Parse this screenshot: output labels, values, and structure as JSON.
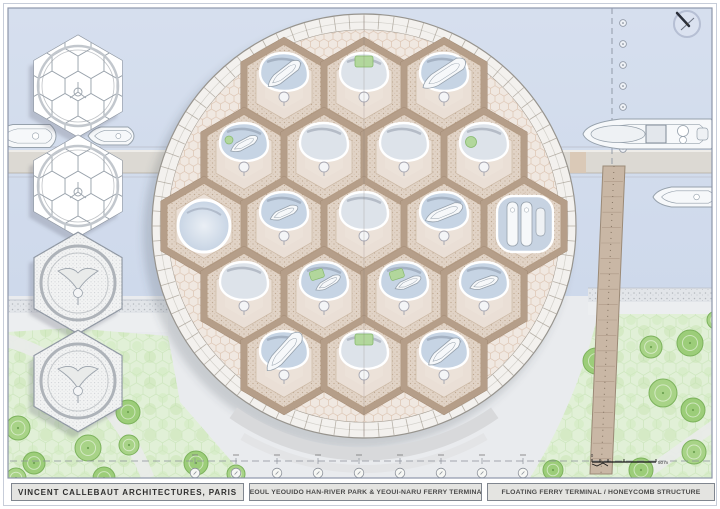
{
  "titleblock": {
    "firm": "VINCENT CALLEBAUT ARCHITECTURES, PARIS",
    "project": "SEOUL YEOUIDO HAN-RIVER PARK & YEOUI-NARU FERRY TERMINAL",
    "drawing": "FLOATING FERRY TERMINAL / HONEYCOMB STRUCTURE"
  },
  "scalebar": {
    "start_label": "0",
    "end_label": "50 m"
  },
  "compass": {
    "type": "north-needle"
  },
  "colors": {
    "water_top": "#d6dfee",
    "water_bottom": "#c9d5e9",
    "land": "#e9ebee",
    "promenade": "#eceef0",
    "sand_base": "#e2e5e9",
    "park": "#e1f0d7",
    "tree": "#a8d387",
    "tree_line": "#7cb25c",
    "band": "#dcd9d1",
    "pier": "#c9b7a5",
    "ring": "#f3f1ee",
    "ring_line": "#a39c92",
    "filler": "#f0e8e1",
    "filler_line": "#ddc5b3",
    "web": "#b59e89",
    "cell": "#e1d3c6",
    "cell_inner": "#eadfd6",
    "cell_core": "#ece2d9",
    "open_blue": "#c6d4e4",
    "open_gray": "#dde3ea",
    "green": "#b2d79c",
    "green_line": "#86b96d",
    "boat": "#f6f8fa",
    "boat_line": "#96a1ac",
    "shadow": "rgba(70,75,90,0.20)",
    "frame": "#8e97ab"
  },
  "plan": {
    "center": [
      364,
      226
    ],
    "outer_radius": 212,
    "ring_radius": 196,
    "hex_width": 80,
    "cells": [
      {
        "x": 284,
        "y": 87,
        "type": "boat",
        "angle": -38
      },
      {
        "x": 364,
        "y": 87,
        "type": "green"
      },
      {
        "x": 444,
        "y": 87,
        "type": "boat-large",
        "angle": -33
      },
      {
        "x": 244,
        "y": 157,
        "type": "boat-green",
        "angle": -28
      },
      {
        "x": 324,
        "y": 157,
        "type": "plain"
      },
      {
        "x": 404,
        "y": 157,
        "type": "plain"
      },
      {
        "x": 484,
        "y": 157,
        "type": "green-side"
      },
      {
        "x": 204,
        "y": 226,
        "type": "pool"
      },
      {
        "x": 284,
        "y": 226,
        "type": "boat-small",
        "angle": -24
      },
      {
        "x": 364,
        "y": 226,
        "type": "plain"
      },
      {
        "x": 444,
        "y": 226,
        "type": "boat",
        "angle": -22
      },
      {
        "x": 524,
        "y": 226,
        "type": "dock"
      },
      {
        "x": 244,
        "y": 296,
        "type": "plain"
      },
      {
        "x": 324,
        "y": 296,
        "type": "green-boat",
        "angle": -30
      },
      {
        "x": 404,
        "y": 296,
        "type": "green-boat",
        "angle": -24
      },
      {
        "x": 484,
        "y": 296,
        "type": "boat-small",
        "angle": -20
      },
      {
        "x": 284,
        "y": 365,
        "type": "boat-large",
        "angle": -48
      },
      {
        "x": 364,
        "y": 365,
        "type": "green"
      },
      {
        "x": 444,
        "y": 365,
        "type": "boat",
        "angle": -40
      }
    ]
  },
  "detail_hexes": [
    {
      "x": 78,
      "y": 86,
      "style": "structure"
    },
    {
      "x": 78,
      "y": 186,
      "style": "structure"
    },
    {
      "x": 78,
      "y": 283,
      "style": "roof"
    },
    {
      "x": 78,
      "y": 381,
      "style": "roof"
    }
  ],
  "boats": [
    {
      "name": "boat-left-outer",
      "cx": 26,
      "cy": 136,
      "length": 60,
      "width": 23,
      "style": "yacht"
    },
    {
      "name": "boat-left-inner",
      "cx": 111,
      "cy": 136,
      "length": 46,
      "width": 18,
      "style": "yacht"
    },
    {
      "name": "ferry",
      "cx": 650,
      "cy": 134,
      "length": 134,
      "width": 30,
      "style": "ferry"
    },
    {
      "name": "boat-right",
      "cx": 686,
      "cy": 197,
      "length": 66,
      "width": 20,
      "style": "yacht"
    }
  ],
  "pier": {
    "x_top": 603,
    "y_top": 166,
    "w_top": 22,
    "x_bottom": 590,
    "y_bottom": 474,
    "w_bottom": 22
  },
  "channel_markers": {
    "x": 612,
    "y1": 8,
    "y2": 168,
    "tick_x": 623,
    "tick_y": [
      23,
      44,
      65,
      86,
      107,
      128,
      149
    ]
  },
  "grid_markers": {
    "line_y": 461,
    "bubble_y": 473,
    "bubble_x": [
      195,
      236,
      277,
      318,
      359,
      400,
      441,
      482,
      523
    ]
  },
  "trees": [
    [
      18,
      428,
      12
    ],
    [
      34,
      463,
      11
    ],
    [
      88,
      448,
      13
    ],
    [
      128,
      412,
      12
    ],
    [
      129,
      445,
      10
    ],
    [
      104,
      478,
      11
    ],
    [
      16,
      478,
      10
    ],
    [
      196,
      463,
      12
    ],
    [
      236,
      474,
      9
    ],
    [
      596,
      361,
      13
    ],
    [
      651,
      347,
      11
    ],
    [
      690,
      343,
      13
    ],
    [
      663,
      393,
      14
    ],
    [
      693,
      410,
      12
    ],
    [
      602,
      428,
      10
    ],
    [
      641,
      470,
      12
    ],
    [
      694,
      452,
      12
    ],
    [
      553,
      470,
      10
    ],
    [
      716,
      320,
      9
    ]
  ]
}
